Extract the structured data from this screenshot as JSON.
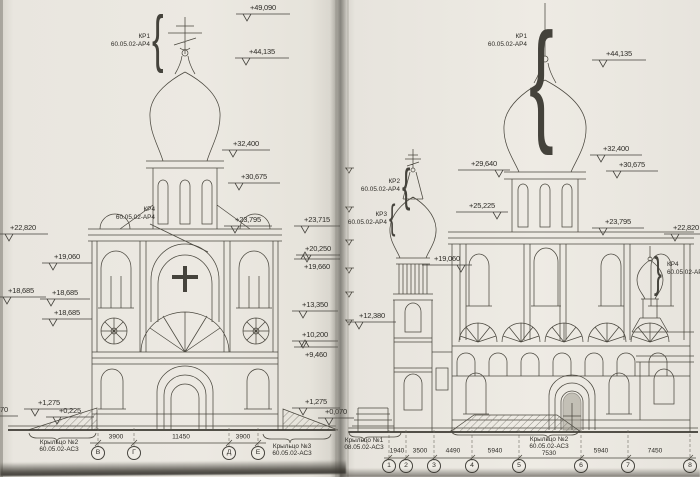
{
  "style": {
    "paper_color": "#ebe8e1",
    "ink_color": "#4b483f"
  },
  "annotations": {
    "elevation_marks": [
      {
        "label": "+49,090",
        "x": 236,
        "y": 14,
        "len": 54
      },
      {
        "label": "+44,135",
        "x": 235,
        "y": 58,
        "len": 54
      },
      {
        "label": "+32,400",
        "x": 222,
        "y": 150,
        "len": 48
      },
      {
        "label": "+30,675",
        "x": 228,
        "y": 183,
        "len": 52
      },
      {
        "label": "+23,795",
        "x": 224,
        "y": 226,
        "len": 48
      },
      {
        "label": "+23,715",
        "x": 294,
        "y": 226,
        "len": 46
      },
      {
        "label": "+20,250",
        "x": 296,
        "y": 255,
        "len": 44
      },
      {
        "label": "+19,660",
        "x": 294,
        "y": 259,
        "len": 46,
        "below": true
      },
      {
        "label": "+13,350",
        "x": 292,
        "y": 311,
        "len": 46
      },
      {
        "label": "+10,200",
        "x": 292,
        "y": 341,
        "len": 46
      },
      {
        "label": "+9,460",
        "x": 294,
        "y": 347,
        "len": 44,
        "below": true
      },
      {
        "label": "+22,820",
        "x": -2,
        "y": 234,
        "len": 50
      },
      {
        "label": "+19,060",
        "x": 42,
        "y": 263,
        "len": 50
      },
      {
        "label": "+18,685",
        "x": -4,
        "y": 297,
        "len": 50
      },
      {
        "label": "+18,685",
        "x": 40,
        "y": 299,
        "len": 50
      },
      {
        "label": "+18,685",
        "x": 42,
        "y": 319,
        "len": 50
      },
      {
        "label": "+1,275",
        "x": 24,
        "y": 409,
        "len": 50
      },
      {
        "label": "+0,070",
        "x": -24,
        "y": 416,
        "len": 42
      },
      {
        "label": "+0,225",
        "x": 46,
        "y": 417,
        "len": 48
      },
      {
        "label": "+1,275",
        "x": 292,
        "y": 408,
        "len": 48
      },
      {
        "label": "+0,070",
        "x": 318,
        "y": 418,
        "len": 36
      },
      {
        "label": "+44,135",
        "x": 592,
        "y": 60,
        "len": 54
      },
      {
        "label": "+32,400",
        "x": 590,
        "y": 155,
        "len": 52
      },
      {
        "label": "+30,675",
        "x": 606,
        "y": 171,
        "len": 52
      },
      {
        "label": "+23,795",
        "x": 592,
        "y": 228,
        "len": 52
      },
      {
        "label": "+22,820",
        "x": 664,
        "y": 234,
        "len": 44
      },
      {
        "label": "+29,640",
        "x": 458,
        "y": 170,
        "len": 52,
        "arrow": "right"
      },
      {
        "label": "+25,225",
        "x": 456,
        "y": 212,
        "len": 52,
        "arrow": "right"
      },
      {
        "label": "+19,060",
        "x": 422,
        "y": 265,
        "len": 50,
        "arrow": "right"
      },
      {
        "label": "+12,380",
        "x": 348,
        "y": 322,
        "len": 48
      }
    ],
    "callouts": [
      {
        "name": "КР1",
        "code": "60.05.02-АР4",
        "x": 150,
        "y": 33,
        "brace": "{",
        "bx": 152,
        "by": 14,
        "bh": 50
      },
      {
        "name": "КР4",
        "code": "60.05.02-АР4",
        "x": 155,
        "y": 206
      },
      {
        "name": "КР1",
        "code": "60.05.02-АР4",
        "x": 527,
        "y": 33,
        "brace": "{",
        "bx": 529,
        "by": 27,
        "bh": 108
      },
      {
        "name": "КР2",
        "code": "60.05.02-АР4",
        "x": 400,
        "y": 178,
        "brace": "{",
        "bx": 402,
        "by": 167,
        "bh": 37
      },
      {
        "name": "КР3",
        "code": "60.05.02-АР4",
        "x": 387,
        "y": 211,
        "brace": "{",
        "bx": 389,
        "by": 204,
        "bh": 28
      },
      {
        "name": "КР4",
        "code": "60.05.02-АР4",
        "x": 667,
        "y": 261,
        "align": "left",
        "brace": "}",
        "bx": 654,
        "by": 256,
        "bh": 34
      }
    ],
    "porch_labels": [
      {
        "lines": [
          "Крыльцо №2",
          "60.05.02-АС3"
        ],
        "x": 59,
        "y": 439
      },
      {
        "lines": [
          "Крыльцо №3",
          "60.05.02-АС3"
        ],
        "x": 292,
        "y": 443
      },
      {
        "lines": [
          "Крыльцо №1",
          "08.05.02-АС3"
        ],
        "x": 364,
        "y": 437
      },
      {
        "lines": [
          "Крыльцо №2",
          "60.05.02-АС3",
          "7530"
        ],
        "x": 549,
        "y": 436
      }
    ],
    "dim_labels": [
      {
        "text": "3900",
        "x": 116,
        "y": 437
      },
      {
        "text": "11450",
        "x": 181,
        "y": 437
      },
      {
        "text": "3900",
        "x": 243,
        "y": 437
      },
      {
        "text": "1940",
        "x": 397,
        "y": 451
      },
      {
        "text": "3500",
        "x": 420,
        "y": 451
      },
      {
        "text": "4490",
        "x": 453,
        "y": 451
      },
      {
        "text": "5940",
        "x": 495,
        "y": 451
      },
      {
        "text": "5940",
        "x": 601,
        "y": 451
      },
      {
        "text": "7450",
        "x": 655,
        "y": 451
      }
    ],
    "axis_bubbles": [
      {
        "label": "В",
        "x": 98,
        "y": 453
      },
      {
        "label": "Г",
        "x": 134,
        "y": 453
      },
      {
        "label": "Д",
        "x": 229,
        "y": 453
      },
      {
        "label": "Е",
        "x": 258,
        "y": 453
      },
      {
        "label": "1",
        "x": 389,
        "y": 466
      },
      {
        "label": "2",
        "x": 406,
        "y": 466
      },
      {
        "label": "3",
        "x": 434,
        "y": 466
      },
      {
        "label": "4",
        "x": 472,
        "y": 466
      },
      {
        "label": "5",
        "x": 519,
        "y": 466
      },
      {
        "label": "6",
        "x": 581,
        "y": 466
      },
      {
        "label": "7",
        "x": 628,
        "y": 466
      },
      {
        "label": "8",
        "x": 690,
        "y": 466
      }
    ]
  }
}
